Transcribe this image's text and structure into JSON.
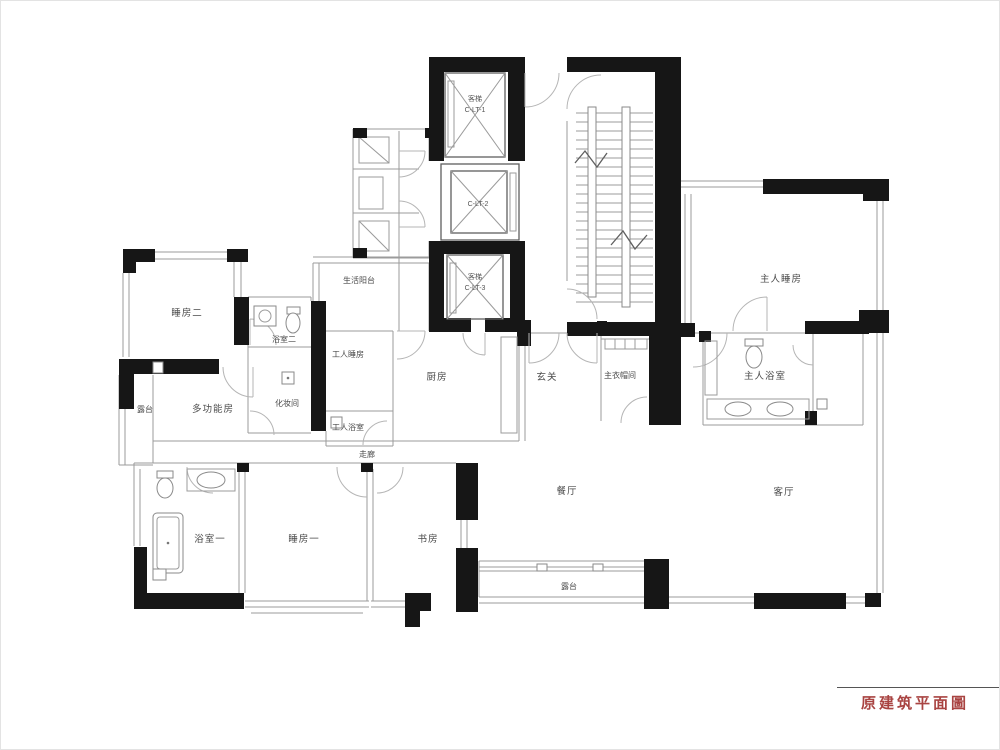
{
  "title_block": {
    "label": "原建筑平面圖",
    "color": "#a94442"
  },
  "floor_plan": {
    "rooms": [
      {
        "id": "bedroom-2",
        "name": "睡房二"
      },
      {
        "id": "bathroom-2",
        "name": "浴室二"
      },
      {
        "id": "dressing-room",
        "name": "化妆间"
      },
      {
        "id": "staff-bedroom",
        "name": "工人睡房"
      },
      {
        "id": "staff-bathroom",
        "name": "工人浴室"
      },
      {
        "id": "kitchen",
        "name": "厨房"
      },
      {
        "id": "service-balcony",
        "name": "生活阳台"
      },
      {
        "id": "foyer",
        "name": "玄关"
      },
      {
        "id": "master-closet",
        "name": "主衣帽间"
      },
      {
        "id": "master-bedroom",
        "name": "主人睡房"
      },
      {
        "id": "master-bathroom",
        "name": "主人浴室"
      },
      {
        "id": "balcony-west",
        "name": "露台"
      },
      {
        "id": "multifunction-room",
        "name": "多功能房"
      },
      {
        "id": "corridor",
        "name": "走廊"
      },
      {
        "id": "bathroom-1",
        "name": "浴室一"
      },
      {
        "id": "bedroom-1",
        "name": "睡房一"
      },
      {
        "id": "study",
        "name": "书房"
      },
      {
        "id": "dining-room",
        "name": "餐厅"
      },
      {
        "id": "living-room",
        "name": "客厅"
      },
      {
        "id": "balcony-south",
        "name": "露台"
      }
    ],
    "elevators": [
      {
        "id": "elevator-1",
        "type_label": "客梯",
        "code": "C-LT-1"
      },
      {
        "id": "elevator-2",
        "type_label": "",
        "code": "C-LT-2"
      },
      {
        "id": "elevator-3",
        "type_label": "客梯",
        "code": "C-LT-3"
      }
    ]
  },
  "colors": {
    "wall": "#161616",
    "thin_line": "#9b9b9b",
    "title": "#a94442"
  }
}
